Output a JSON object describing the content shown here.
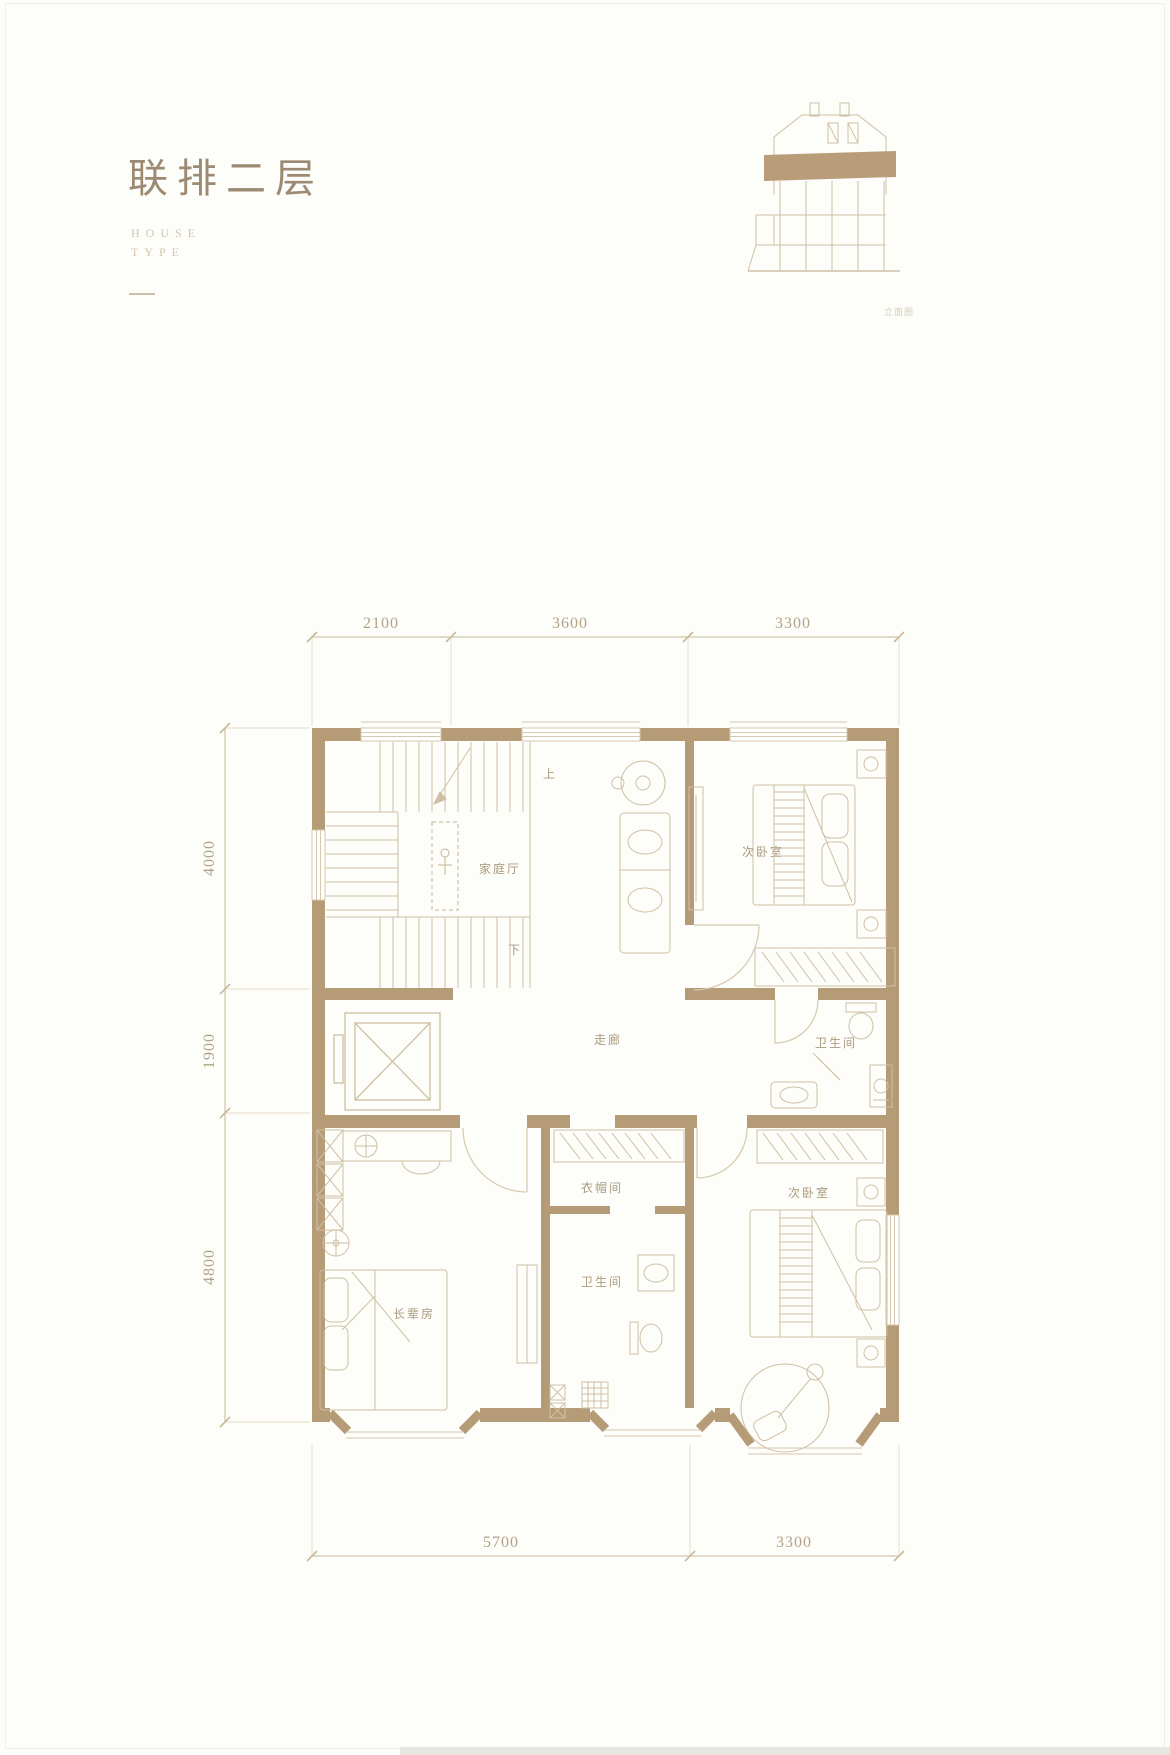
{
  "header": {
    "title": "联排二层",
    "subtitle_line1": "HOUSE",
    "subtitle_line2": "TYPE"
  },
  "elevation": {
    "caption": "立面图"
  },
  "plan": {
    "rooms": {
      "family_hall": "家庭厅",
      "bedroom_top": "次卧室",
      "corridor": "走廊",
      "bath_top": "卫生间",
      "cloakroom": "衣帽间",
      "bath_bottom": "卫生间",
      "elder_room": "长辈房",
      "bedroom_bottom": "次卧室"
    },
    "stairs": {
      "up": "上",
      "down": "下"
    },
    "dims_top": [
      "2100",
      "3600",
      "3300"
    ],
    "dims_left": [
      "4000",
      "1900",
      "4800"
    ],
    "dims_bottom": [
      "5700",
      "3300"
    ]
  },
  "colors": {
    "wall": "#b59b76",
    "furniture_line": "#cfc0a4",
    "dimension_text": "#b3a287",
    "title_text": "#9c8a72"
  }
}
